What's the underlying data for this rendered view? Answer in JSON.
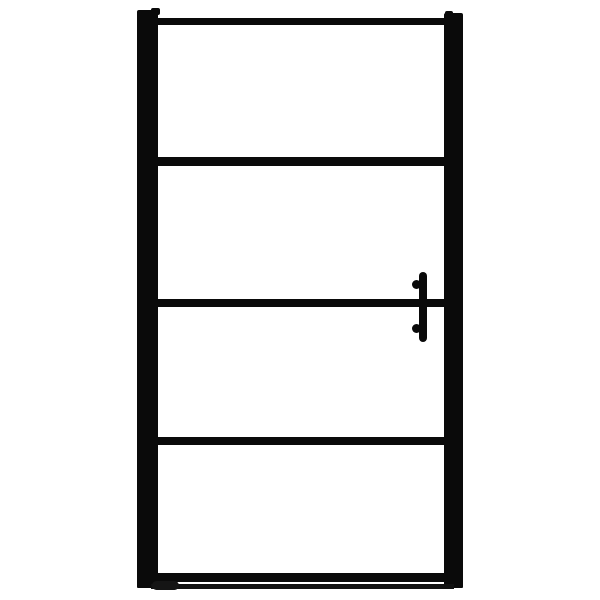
{
  "scene": {
    "description": "Front view of a black-framed transparent glass door (shower/pivot door) on a plain white background, product-photo style",
    "object": "framed-glass-door",
    "panel_count": 4,
    "horizontal_bar_count": 5,
    "vertical_stile_count": 2,
    "handle_side": "right",
    "handle_type": "vertical-bar-with-two-round-mounts",
    "threshold_strip": "thin horizontal strip under the bottom rail",
    "visible_text": ""
  },
  "colors": {
    "frame": "#0a0a0a",
    "background": "#ffffff"
  }
}
